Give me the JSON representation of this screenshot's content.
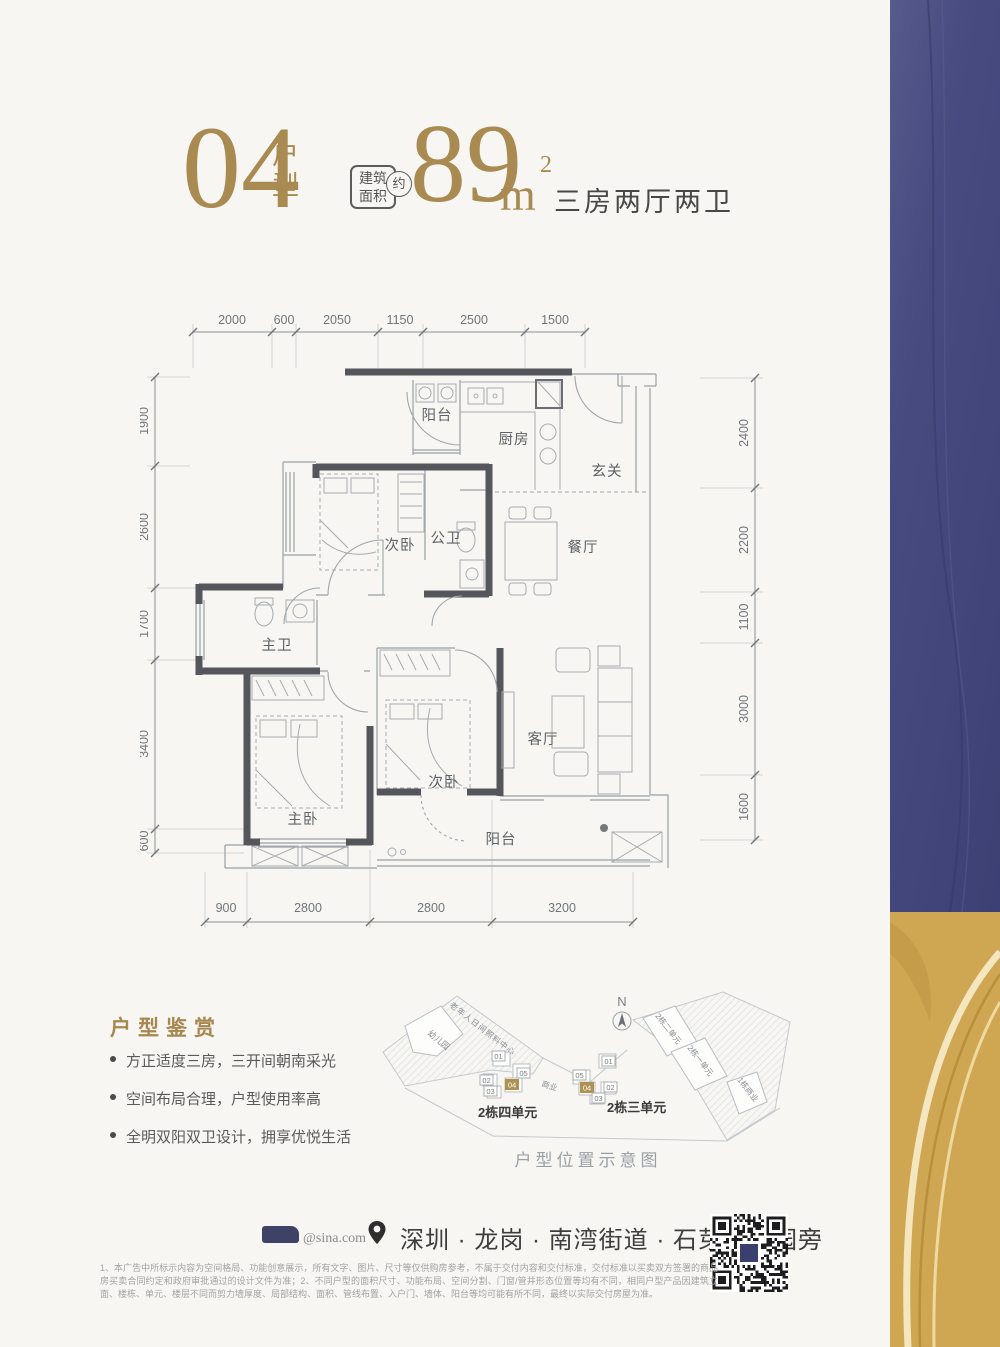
{
  "header": {
    "unit_number": "04",
    "unit_suffix": "户型",
    "area_box_line1": "建筑",
    "area_box_line2": "面积",
    "area_approx": "约",
    "area_value": "89",
    "area_unit": "m",
    "area_sup": "2",
    "layout_desc": "三房两厅两卫"
  },
  "plan": {
    "rooms": {
      "balcony_top": "阳台",
      "kitchen": "厨房",
      "foyer": "玄关",
      "bedroom2_top": "次卧",
      "bath_public": "公卫",
      "dining": "餐厅",
      "bath_master": "主卫",
      "living": "客厅",
      "bedroom2_bottom": "次卧",
      "bedroom_master": "主卧",
      "balcony_bottom": "阳台"
    },
    "dims": {
      "top": [
        "2000",
        "600",
        "2050",
        "1150",
        "2500",
        "1500"
      ],
      "left": [
        "1900",
        "2600",
        "1700",
        "3400",
        "600"
      ],
      "right": [
        "2400",
        "2200",
        "1100",
        "3000",
        "1600"
      ],
      "bottom": [
        "900",
        "2800",
        "2800",
        "3200"
      ]
    }
  },
  "appreciation": {
    "title": "户型鉴赏",
    "bullets": [
      "方正适度三房，三开间朝南采光",
      "空间布局合理，户型使用率高",
      "全明双阳双卫设计，拥享优悦生活"
    ]
  },
  "siteplan": {
    "north_label": "N",
    "left_band_text": "老年人日间照料中心",
    "kindergarten": "幼儿园",
    "commerce": "商业",
    "units_left": [
      "01",
      "05",
      "02",
      "03",
      "04"
    ],
    "units_right": [
      "05",
      "04",
      "01",
      "02",
      "03"
    ],
    "cluster_left_caption": "2栋四单元",
    "cluster_right_caption": "2栋三单元",
    "building_unit2": "2栋二单元",
    "building_unit1": "2栋一单元",
    "commerce_building": "1栋商业",
    "caption": "户型位置示意图"
  },
  "footer": {
    "logo_handle": "@sina.com",
    "address": "深圳 · 龙岗 · 南湾街道 · 石芽岭公园旁"
  },
  "disclaimer": "1、本广告中所标示内容为空间格局、功能创意展示，所有文字、图片、尺寸等仅供购房参考，不属于交付内容和交付标准，交付标准以买卖双方签署的商品房买卖合同约定和政府审批通过的设计文件为准；2、不同户型的面积尺寸、功能布局、空间分割、门窗/管井形态位置等均有不同，相同户型产品因建筑立面、楼栋、单元、楼层不同而剪力墙厚度、局部结构、面积、管线布置、入户门、墙体、阳台等均可能有所不同，最终以实际交付房屋为准。",
  "colors": {
    "gold_accent": "#a8874f",
    "navy_band": "#474b80",
    "gold_band": "#cfa753",
    "wall": "#54565b",
    "unit_chip_gold": "#b09154"
  }
}
